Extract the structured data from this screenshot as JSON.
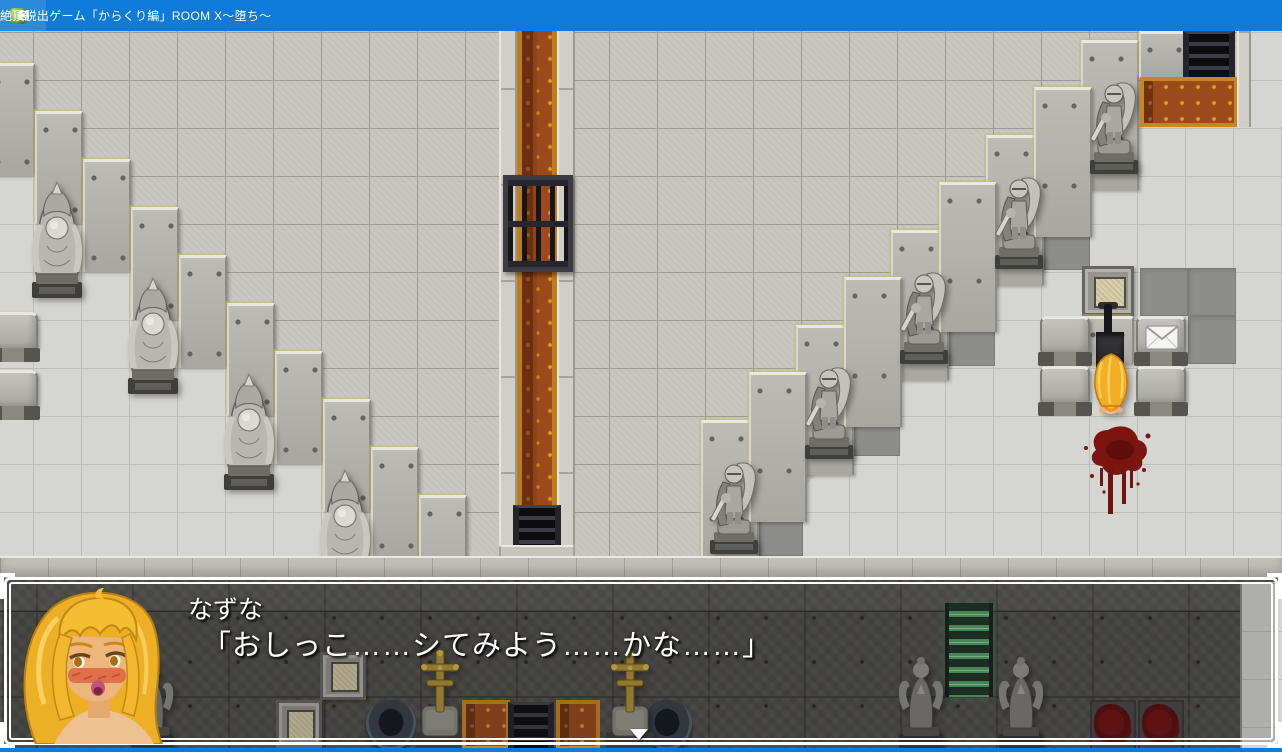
{
  "window": {
    "title": "絶頂脱出ゲーム「からくり編」ROOM X～堕ち～",
    "icon": "game-icon",
    "controls": {
      "minimize": "minimize",
      "maximize": "maximize",
      "close": "✕"
    }
  },
  "dialogue": {
    "speaker": "なずな",
    "line": "「おしっこ……シてみよう……かな……」"
  },
  "colors": {
    "titlebar": "#0f7ad7",
    "floor_rough": "#c9c6bf",
    "floor_smooth": "#d5d5d1",
    "dark_tile": "#8d8d8a",
    "wall_stone": "#b3b2ac",
    "carpet": "#9c4a1c",
    "carpet_gold": "#c9851f",
    "blood": "#7c1410",
    "hair": "#f0b22a",
    "ladder_green": "#57a266"
  },
  "map": {
    "statues": {
      "monk": 4,
      "knight": 5,
      "angel": 3
    },
    "props": [
      "carpet-corridor",
      "portcullis-gate",
      "wall-niche",
      "lever",
      "switch-pedestals",
      "envelope-tile",
      "blood-splatter",
      "green-ladder",
      "gold-cross",
      "well",
      "dark-grate",
      "blood-panels"
    ]
  },
  "icons": {
    "envelope": "envelope-icon",
    "pause_cursor": "down-triangle"
  }
}
